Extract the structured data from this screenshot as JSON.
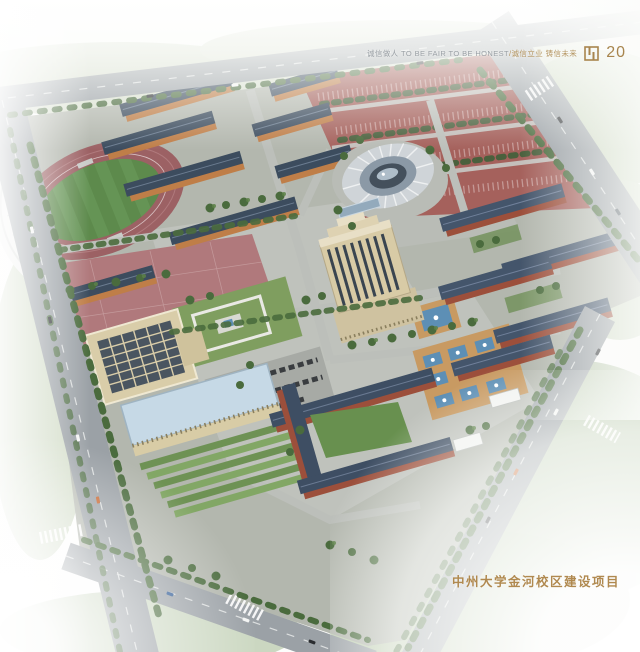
{
  "page": {
    "width": 640,
    "height": 652,
    "background_color": "#fdfdfc",
    "description": "Aerial architectural rendering of a university campus master plan on a hazy white brochure page"
  },
  "header": {
    "slogan_cn_primary": "诚信做人",
    "slogan_en": "TO BE FAIR TO BE HONEST",
    "slogan_divider": "/",
    "slogan_cn_secondary": "诚信立业 铸信未来",
    "page_number": "20",
    "logo_icon": "gold-seal-mark",
    "text_color": "#9aa0a5",
    "accent_color": "#a8854e"
  },
  "footer": {
    "project_title": "中州大学金河校区建设项目",
    "color": "#b0894f"
  },
  "scene": {
    "landmarks": [
      "running-track-stadium",
      "grandstand-canopy",
      "north-dormitory-cluster",
      "red-paved-courts-parking",
      "domed-gymnasium",
      "central-library-tower",
      "east-teaching-cluster",
      "u-shaped-dormitory",
      "administration-complex",
      "central-lawn-quad",
      "fountain-plaza",
      "lawn-terraces",
      "perimeter-ring-roads",
      "street-trees",
      "cars"
    ],
    "colors": {
      "track": "#9c6164",
      "field_green": "#5d8a4c",
      "dorm_roof": "#3c4c5e",
      "dorm_facade": "#bf7e48",
      "brick_facade": "#9c4f3b",
      "courts_red": "#a5615c",
      "tower_beige": "#d8cba6",
      "gym_dome": "#cfd4d8",
      "admin_roof_blue": "#c6d9e6",
      "road_gray": "#9ba1a6",
      "lawn": "#7f9e5f",
      "tree_green": "#4a6b3d",
      "pool_blue": "#5d8fb5",
      "deck_tan": "#c89a62"
    }
  }
}
